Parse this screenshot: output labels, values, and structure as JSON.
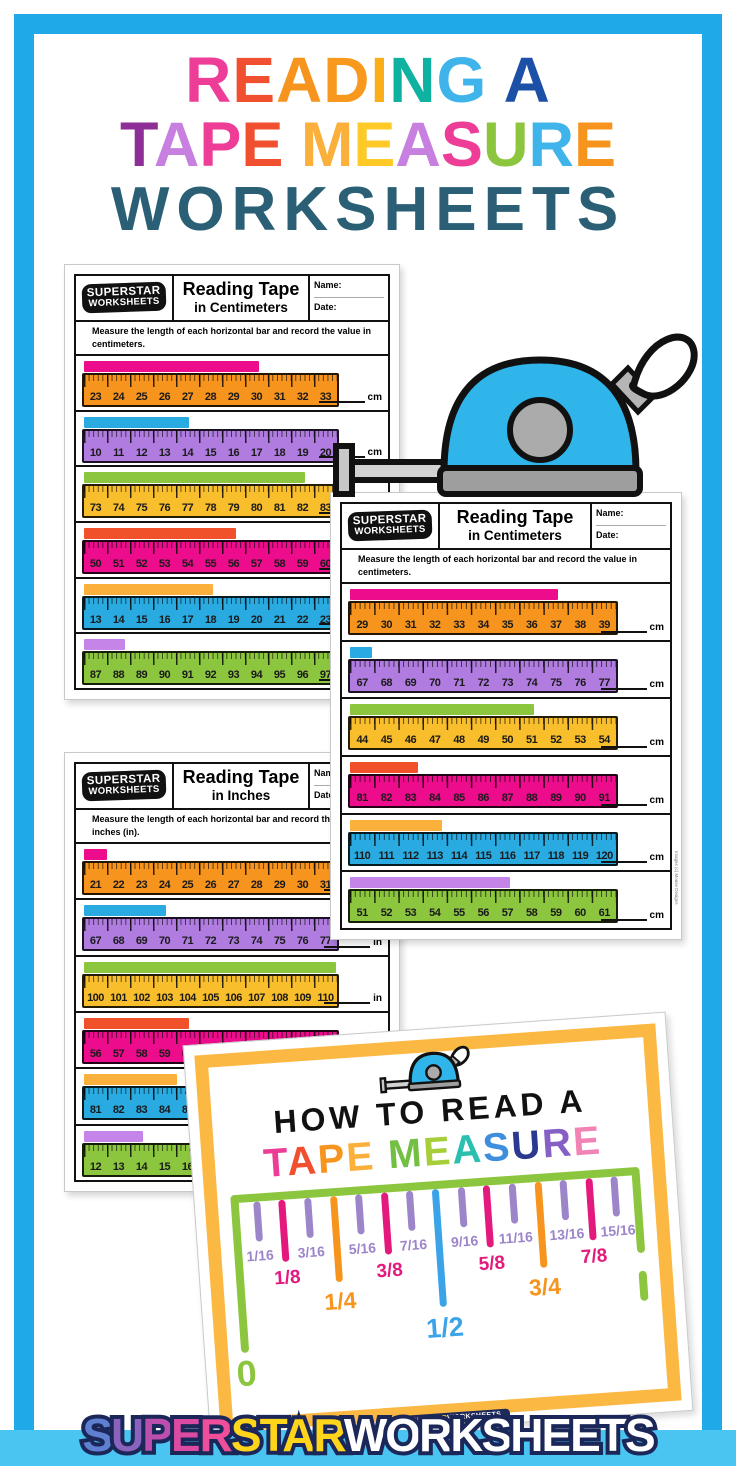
{
  "colors": {
    "frame_blue": "#1FA9E8",
    "footer_stripe_blue": "#4AC4F1",
    "howto_frame_yellow": "#FBB843",
    "howto_ruler_green": "#8CC63F",
    "tape_body_blue": "#2FB5EA"
  },
  "icons": {
    "tape_measure_large": "tape-measure-icon",
    "tape_measure_small": "tape-measure-icon"
  },
  "title": {
    "line1": [
      {
        "ch": "R",
        "c": "#EE3D96"
      },
      {
        "ch": "E",
        "c": "#F0502F"
      },
      {
        "ch": "A",
        "c": "#F7941E"
      },
      {
        "ch": "D",
        "c": "#F8991D"
      },
      {
        "ch": "I",
        "c": "#FBAE17"
      },
      {
        "ch": "N",
        "c": "#0FB2A1"
      },
      {
        "ch": "G",
        "c": "#3FB4EA"
      },
      {
        "ch": " ",
        "c": "#000000"
      },
      {
        "ch": "A",
        "c": "#1C4FA6"
      }
    ],
    "line2": [
      {
        "ch": "T",
        "c": "#8E2E97"
      },
      {
        "ch": "A",
        "c": "#C77FE0"
      },
      {
        "ch": "P",
        "c": "#EE3D96"
      },
      {
        "ch": "E",
        "c": "#F0502F"
      },
      {
        "ch": " ",
        "c": "#000000"
      },
      {
        "ch": "M",
        "c": "#FBB03B"
      },
      {
        "ch": "E",
        "c": "#FFC928"
      },
      {
        "ch": "A",
        "c": "#C77FE0"
      },
      {
        "ch": "S",
        "c": "#EE3D96"
      },
      {
        "ch": "U",
        "c": "#8CC63F"
      },
      {
        "ch": "R",
        "c": "#3FB4EA"
      },
      {
        "ch": "E",
        "c": "#F7941E"
      }
    ],
    "line3": {
      "text": "WORKSHEETS",
      "color": "#2A5F76"
    }
  },
  "worksheets": [
    {
      "logo_line1": "SUPERSTAR",
      "logo_line2": "WORKSHEETS",
      "title_line1": "Reading Tape",
      "title_line2": "in Centimeters",
      "name_label": "Name:",
      "date_label": "Date:",
      "instructions": "Measure the length of each horizontal bar and record the value in centimeters.",
      "unit": "cm",
      "rows": [
        {
          "bar_color": "#EC0C8C",
          "ruler_color": "#F7941E",
          "bar_pct": 68,
          "numbers": [
            23,
            24,
            25,
            26,
            27,
            28,
            29,
            30,
            31,
            32,
            33
          ]
        },
        {
          "bar_color": "#29ABE2",
          "ruler_color": "#B07CE0",
          "bar_pct": 41,
          "numbers": [
            10,
            11,
            12,
            13,
            14,
            15,
            16,
            17,
            18,
            19,
            20
          ]
        },
        {
          "bar_color": "#8CC63F",
          "ruler_color": "#F9BE2B",
          "bar_pct": 86,
          "numbers": [
            73,
            74,
            75,
            76,
            77,
            78,
            79,
            80,
            81,
            82,
            83
          ]
        },
        {
          "bar_color": "#F0512A",
          "ruler_color": "#EC0C8C",
          "bar_pct": 59,
          "numbers": [
            50,
            51,
            52,
            53,
            54,
            55,
            56,
            57,
            58,
            59,
            60
          ]
        },
        {
          "bar_color": "#FBB03B",
          "ruler_color": "#29ABE2",
          "bar_pct": 50,
          "numbers": [
            13,
            14,
            15,
            16,
            17,
            18,
            19,
            20,
            21,
            22,
            23
          ]
        },
        {
          "bar_color": "#C584E8",
          "ruler_color": "#8CC63F",
          "bar_pct": 16,
          "numbers": [
            87,
            88,
            89,
            90,
            91,
            92,
            93,
            94,
            95,
            96,
            97
          ]
        }
      ]
    },
    {
      "logo_line1": "SUPERSTAR",
      "logo_line2": "WORKSHEETS",
      "title_line1": "Reading Tape",
      "title_line2": "in Centimeters",
      "name_label": "Name:",
      "date_label": "Date:",
      "instructions": "Measure the length of each horizontal bar and record the value in centimeters.",
      "unit": "cm",
      "credit": "Images (c) Mouse Designs",
      "rows": [
        {
          "bar_color": "#EC0C8C",
          "ruler_color": "#F7941E",
          "bar_pct": 77,
          "numbers": [
            29,
            30,
            31,
            32,
            33,
            34,
            35,
            36,
            37,
            38,
            39
          ]
        },
        {
          "bar_color": "#29ABE2",
          "ruler_color": "#B07CE0",
          "bar_pct": 8,
          "numbers": [
            67,
            68,
            69,
            70,
            71,
            72,
            73,
            74,
            75,
            76,
            77
          ]
        },
        {
          "bar_color": "#8CC63F",
          "ruler_color": "#F9BE2B",
          "bar_pct": 68,
          "numbers": [
            44,
            45,
            46,
            47,
            48,
            49,
            50,
            51,
            52,
            53,
            54
          ]
        },
        {
          "bar_color": "#F0512A",
          "ruler_color": "#EC0C8C",
          "bar_pct": 25,
          "numbers": [
            81,
            82,
            83,
            84,
            85,
            86,
            87,
            88,
            89,
            90,
            91
          ]
        },
        {
          "bar_color": "#FBB03B",
          "ruler_color": "#29ABE2",
          "bar_pct": 34,
          "numbers": [
            110,
            111,
            112,
            113,
            114,
            115,
            116,
            117,
            118,
            119,
            120
          ]
        },
        {
          "bar_color": "#C584E8",
          "ruler_color": "#8CC63F",
          "bar_pct": 59,
          "numbers": [
            51,
            52,
            53,
            54,
            55,
            56,
            57,
            58,
            59,
            60,
            61
          ]
        }
      ]
    },
    {
      "logo_line1": "SUPERSTAR",
      "logo_line2": "WORKSHEETS",
      "title_line1": "Reading Tape",
      "title_line2": "in Inches",
      "name_label": "Name:",
      "date_label": "Date:",
      "instructions": "Measure the length of each horizontal bar and record the value in inches (in).",
      "unit": "in",
      "rows": [
        {
          "bar_color": "#EC0C8C",
          "ruler_color": "#F7941E",
          "bar_pct": 9,
          "numbers": [
            21,
            22,
            23,
            24,
            25,
            26,
            27,
            28,
            29,
            30,
            31
          ]
        },
        {
          "bar_color": "#29ABE2",
          "ruler_color": "#B07CE0",
          "bar_pct": 32,
          "numbers": [
            67,
            68,
            69,
            70,
            71,
            72,
            73,
            74,
            75,
            76,
            77
          ]
        },
        {
          "bar_color": "#8CC63F",
          "ruler_color": "#F9BE2B",
          "bar_pct": 98,
          "numbers": [
            100,
            101,
            102,
            103,
            104,
            105,
            106,
            107,
            108,
            109,
            110
          ]
        },
        {
          "bar_color": "#F0512A",
          "ruler_color": "#EC0C8C",
          "bar_pct": 41,
          "numbers": [
            56,
            57,
            58,
            59,
            60,
            61,
            62,
            63,
            64,
            65,
            66
          ]
        },
        {
          "bar_color": "#FBB03B",
          "ruler_color": "#29ABE2",
          "bar_pct": 36,
          "numbers": [
            81,
            82,
            83,
            84,
            85,
            86,
            87,
            88,
            89,
            90,
            91
          ]
        },
        {
          "bar_color": "#C584E8",
          "ruler_color": "#8CC63F",
          "bar_pct": 23,
          "numbers": [
            12,
            13,
            14,
            15,
            16,
            17,
            18,
            19,
            20,
            21,
            22
          ]
        }
      ]
    }
  ],
  "howto": {
    "heading1": "HOW TO READ A",
    "heading2": [
      {
        "ch": "T",
        "c": "#EE3D96"
      },
      {
        "ch": "A",
        "c": "#F0502F"
      },
      {
        "ch": "P",
        "c": "#F7941E"
      },
      {
        "ch": "E",
        "c": "#FBB03B"
      },
      {
        "ch": " ",
        "c": "#000000"
      },
      {
        "ch": "M",
        "c": "#72BF44"
      },
      {
        "ch": "E",
        "c": "#A6CE39"
      },
      {
        "ch": "A",
        "c": "#2BBFB0"
      },
      {
        "ch": "S",
        "c": "#3E8EDE"
      },
      {
        "ch": "U",
        "c": "#2B3990"
      },
      {
        "ch": "R",
        "c": "#8660C5"
      },
      {
        "ch": "E",
        "c": "#F283B5"
      }
    ],
    "zero_label": "0",
    "one_label": "1",
    "ticks": [
      {
        "label": "1/16",
        "color": "#9C85C9",
        "size": "s"
      },
      {
        "label": "1/8",
        "color": "#E3197E",
        "size": "m"
      },
      {
        "label": "3/16",
        "color": "#9C85C9",
        "size": "s"
      },
      {
        "label": "1/4",
        "color": "#F7941E",
        "size": "l"
      },
      {
        "label": "5/16",
        "color": "#9C85C9",
        "size": "s"
      },
      {
        "label": "3/8",
        "color": "#E3197E",
        "size": "m"
      },
      {
        "label": "7/16",
        "color": "#9C85C9",
        "size": "s"
      },
      {
        "label": "1/2",
        "color": "#3BA3E8",
        "size": "xl"
      },
      {
        "label": "9/16",
        "color": "#9C85C9",
        "size": "s"
      },
      {
        "label": "5/8",
        "color": "#E3197E",
        "size": "m"
      },
      {
        "label": "11/16",
        "color": "#9C85C9",
        "size": "s"
      },
      {
        "label": "3/4",
        "color": "#F7941E",
        "size": "l"
      },
      {
        "label": "13/16",
        "color": "#9C85C9",
        "size": "s"
      },
      {
        "label": "7/8",
        "color": "#E3197E",
        "size": "m"
      },
      {
        "label": "15/16",
        "color": "#9C85C9",
        "size": "s"
      }
    ],
    "mini_logo": [
      {
        "ch": "SUPER",
        "c": "#E84E9B"
      },
      {
        "ch": "STAR",
        "c": "#FFD51C"
      },
      {
        "ch": "WORKSHEETS",
        "c": "#FFFFFF"
      }
    ]
  },
  "footer": {
    "logo_letters": [
      {
        "ch": "S",
        "c": "#5F7FD1"
      },
      {
        "ch": "U",
        "c": "#8A63BC"
      },
      {
        "ch": "P",
        "c": "#BC4FAE"
      },
      {
        "ch": "E",
        "c": "#DC4BA2"
      },
      {
        "ch": "R",
        "c": "#EF4E9B"
      },
      {
        "ch": "S",
        "c": "#FFD51C"
      },
      {
        "ch": "T",
        "c": "#FFD51C"
      },
      {
        "ch": "A",
        "c": "#FFD51C"
      },
      {
        "ch": "R",
        "c": "#FFD51C"
      },
      {
        "ch": "W",
        "c": "#FFFFFF"
      },
      {
        "ch": "O",
        "c": "#FFFFFF"
      },
      {
        "ch": "R",
        "c": "#FFFFFF"
      },
      {
        "ch": "K",
        "c": "#FFFFFF"
      },
      {
        "ch": "S",
        "c": "#FFFFFF"
      },
      {
        "ch": "H",
        "c": "#FFFFFF"
      },
      {
        "ch": "E",
        "c": "#FFFFFF"
      },
      {
        "ch": "E",
        "c": "#FFFFFF"
      },
      {
        "ch": "T",
        "c": "#FFFFFF"
      },
      {
        "ch": "S",
        "c": "#FFFFFF"
      }
    ]
  }
}
